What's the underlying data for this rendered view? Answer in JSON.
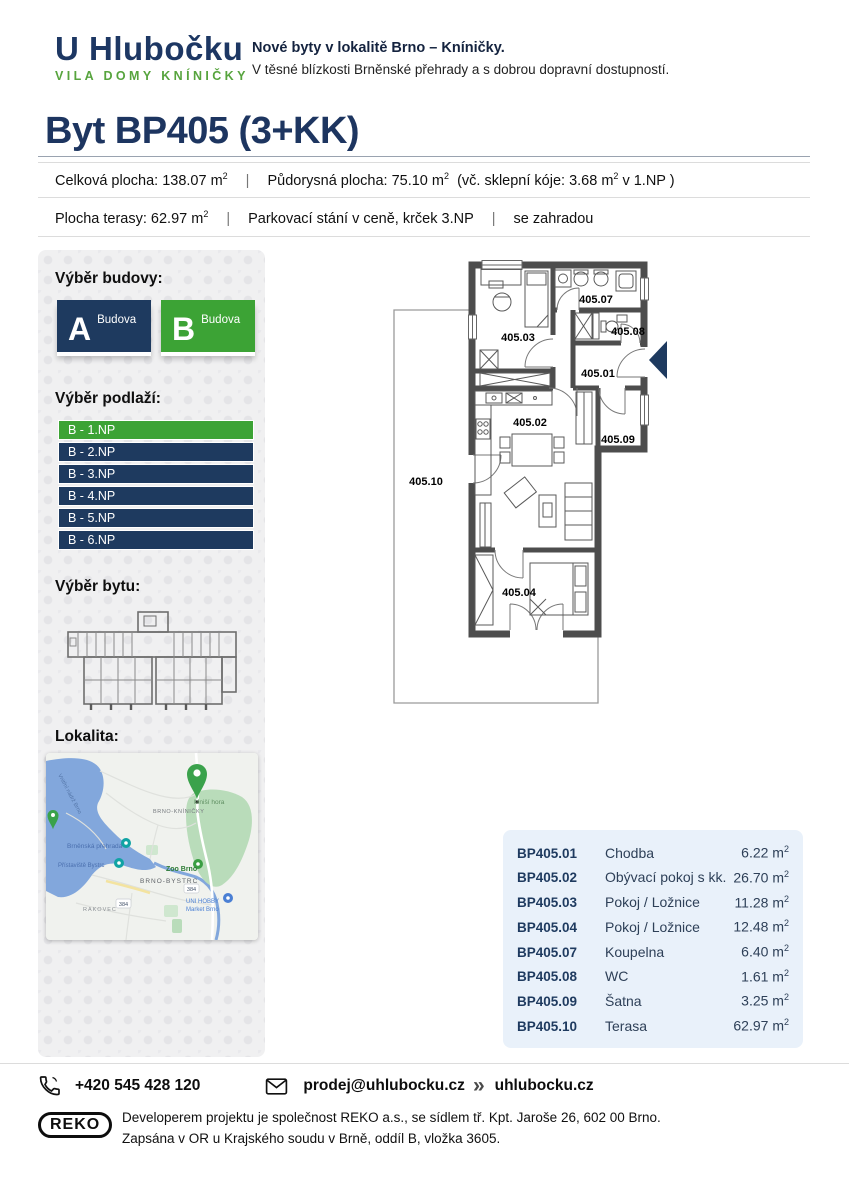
{
  "brand": {
    "logo_title": "U Hlubočku",
    "logo_subtitle": "VILA DOMY KNÍNIČKY",
    "tagline_bold": "Nové byty v lokalitě Brno – Kníničky.",
    "tagline_text": "V těsné blízkosti Brněnské přehrady a s dobrou dopravní dostupností."
  },
  "page": {
    "title": "Byt BP405 (3+KK)"
  },
  "info_bar1": {
    "part1": "Celková plocha: 138.07 m",
    "part1_sup": "2",
    "divider": "|",
    "part2": "Půdorysná plocha: 75.10 m",
    "part2_sup": "2",
    "part3": "(vč. sklepní kóje: 3.68 m",
    "part3_sup": "2",
    "part3_end": " v 1.NP )"
  },
  "info_bar2": {
    "part1": "Plocha terasy:  62.97 m",
    "part1_sup": "2",
    "divider1": "|",
    "part2": "Parkovací stání v ceně, krček 3.NP",
    "divider2": "|",
    "part3": "se zahradou"
  },
  "sidebar": {
    "building_heading": "Výběr budovy:",
    "building_a": {
      "letter": "A",
      "label": "Budova"
    },
    "building_b": {
      "letter": "B",
      "label": "Budova"
    },
    "floor_heading": "Výběr podlaží:",
    "floors": [
      {
        "label": "B - 1.NP",
        "selected": true
      },
      {
        "label": "B - 2.NP",
        "selected": false
      },
      {
        "label": "B - 3.NP",
        "selected": false
      },
      {
        "label": "B - 4.NP",
        "selected": false
      },
      {
        "label": "B - 5.NP",
        "selected": false
      },
      {
        "label": "B - 6.NP",
        "selected": false
      }
    ],
    "unit_heading": "Výběr bytu:",
    "location_heading": "Lokalita:"
  },
  "map": {
    "labels": {
      "water": "Vnitřní nádrž Brno",
      "kninicky": "BRNO-KNÍNIČKY",
      "hora": "Mniší hora",
      "prehrada": "Brněnská přehrada",
      "pristaviste": "Přístaviště Bystrc",
      "zoo": "Zoo Brno",
      "bystrc": "BRNO-BYSTRC",
      "road": "384",
      "uni1": "UNI HOBBY",
      "uni2": "Market Brno",
      "rakovec": "RAKOVEC"
    }
  },
  "plan": {
    "labels": {
      "r01": "405.01",
      "r02": "405.02",
      "r03": "405.03",
      "r04": "405.04",
      "r07": "405.07",
      "r08": "405.08",
      "r09": "405.09",
      "r10": "405.10"
    }
  },
  "rooms_table": {
    "rows": [
      {
        "code": "BP405.01",
        "name": "Chodba",
        "area": "6.22 m",
        "sup": "2"
      },
      {
        "code": "BP405.02",
        "name": "Obývací pokoj s kk.",
        "area": "26.70 m",
        "sup": "2"
      },
      {
        "code": "BP405.03",
        "name": "Pokoj / Ložnice",
        "area": "11.28 m",
        "sup": "2"
      },
      {
        "code": "BP405.04",
        "name": "Pokoj / Ložnice",
        "area": "12.48 m",
        "sup": "2"
      },
      {
        "code": "BP405.07",
        "name": "Koupelna",
        "area": "6.40 m",
        "sup": "2"
      },
      {
        "code": "BP405.08",
        "name": "WC",
        "area": "1.61 m",
        "sup": "2"
      },
      {
        "code": "BP405.09",
        "name": "Šatna",
        "area": "3.25 m",
        "sup": "2"
      },
      {
        "code": "BP405.10",
        "name": "Terasa",
        "area": "62.97 m",
        "sup": "2"
      }
    ]
  },
  "contact": {
    "phone": "+420 545 428 120",
    "email": "prodej@uhlubocku.cz",
    "separator_icon": "»",
    "website": "uhlubocku.cz"
  },
  "footer": {
    "reko_label": "REKO",
    "line1": "Developerem projektu je společnost REKO a.s., se sídlem tř. Kpt. Jaroše 26, 602 00 Brno.",
    "line2": "Zapsána v OR u Krajského soudu v Brně, oddíl B, vložka 3605."
  },
  "colors": {
    "navy": "#1e3a5f",
    "green": "#3ca335",
    "table_bg": "#e9f1fa"
  }
}
